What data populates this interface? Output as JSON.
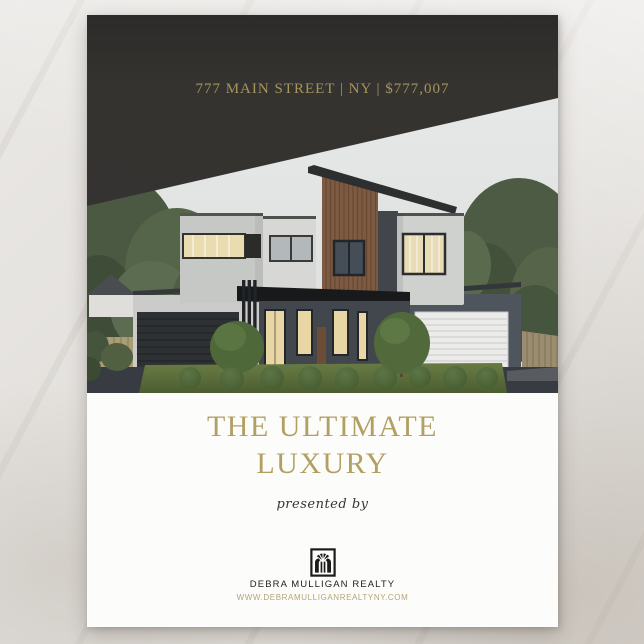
{
  "flyer": {
    "header": {
      "address": "777 MAIN STREET | NY | $777,007"
    },
    "title": {
      "line1": "THE ULTIMATE",
      "line2": "LUXURY"
    },
    "presented_by": "presented by",
    "brand": {
      "name": "DEBRA MULLIGAN REALTY",
      "website": "WWW.DEBRAMULLIGANREALTYNY.COM",
      "logo_icon": "arched-window-realty-logo"
    },
    "photo": {
      "subject": "modern two-story house, wood accent facade, topiary lawn, double garages"
    },
    "colors": {
      "gold_header": "#a6955e",
      "gold_title": "#b2a063",
      "gold_website": "#b5a478",
      "overlay_dark": "#343331",
      "paper": "#fcfcfb"
    }
  }
}
